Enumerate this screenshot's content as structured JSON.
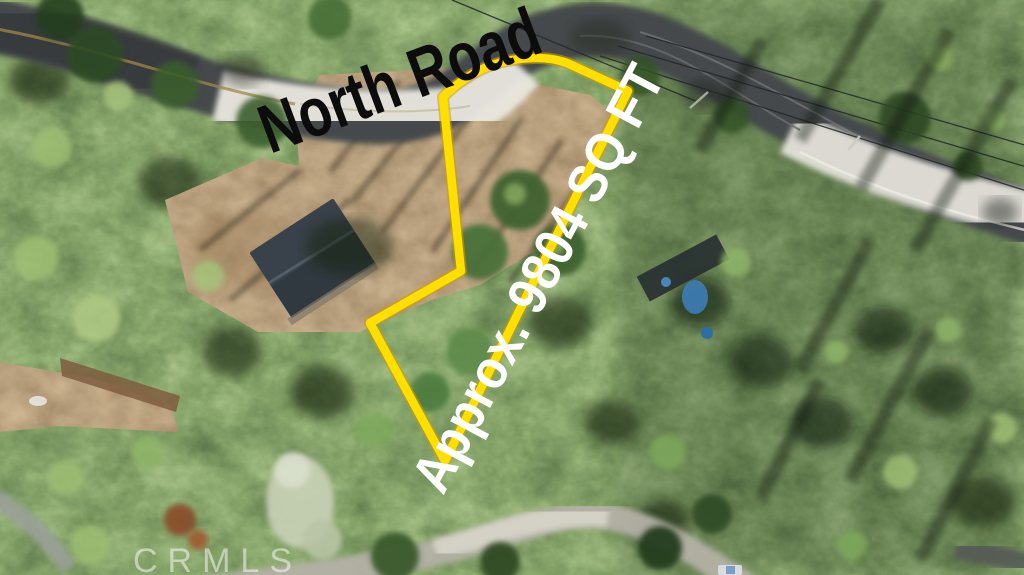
{
  "annotations": {
    "road_label": "North Road",
    "area_label": "Approx. 9804 SQ FT",
    "watermark": "CRMLS"
  },
  "boundary": {
    "color": "#ffdf00",
    "path": "M443,97 C454,86 470,73 492,65 C520,56 549,56 567,63 L628,91 L445,461 L370,323 L461,271 Z"
  },
  "colors": {
    "road_label": "#0c0c0c",
    "area_label": "#ffffff",
    "watermark": "rgba(255,255,255,0.5)"
  }
}
